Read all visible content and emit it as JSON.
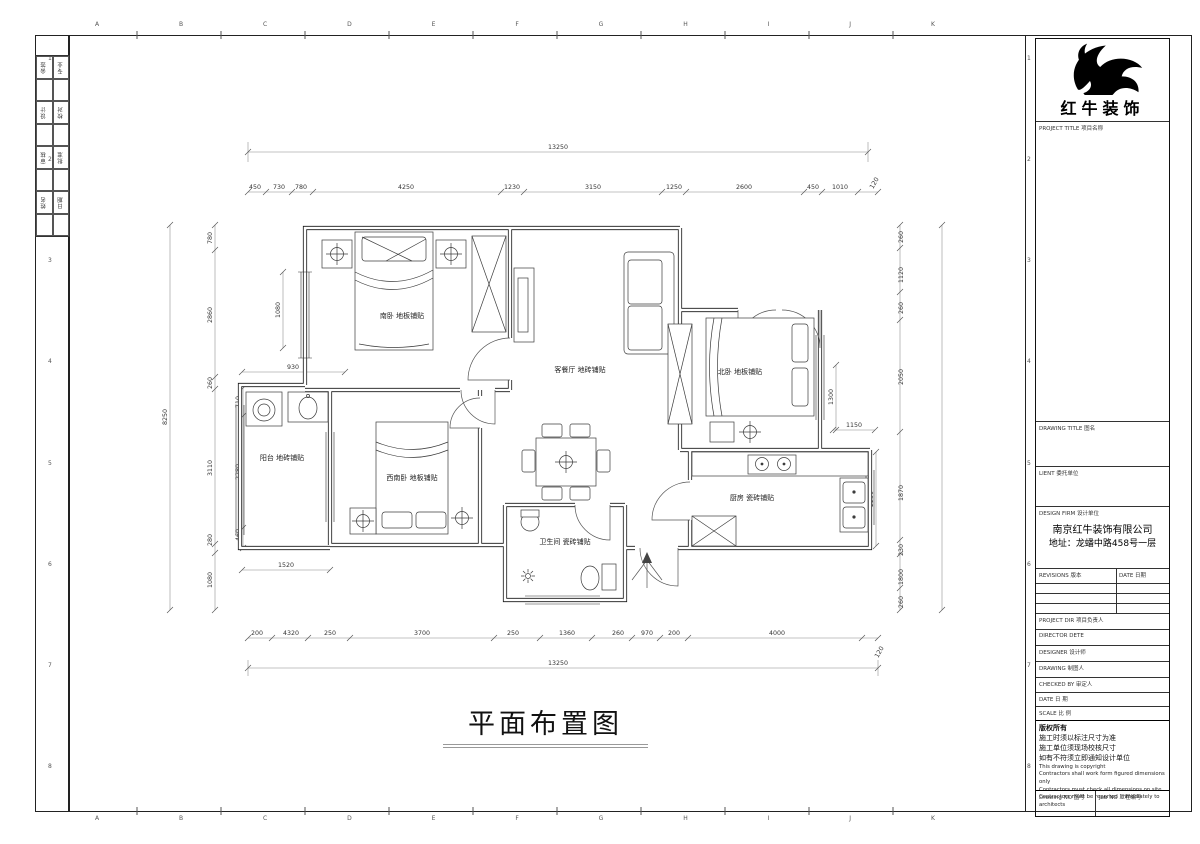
{
  "sheet": {
    "top_letters": [
      "A",
      "B",
      "C",
      "D",
      "E",
      "F",
      "G",
      "H",
      "I",
      "J",
      "K"
    ],
    "bottom_letters": [
      "A",
      "B",
      "C",
      "D",
      "E",
      "F",
      "G",
      "H",
      "I",
      "J",
      "K"
    ],
    "left_numbers": [
      "1",
      "2",
      "3",
      "4",
      "5",
      "6",
      "7",
      "8"
    ],
    "right_numbers": [
      "1",
      "2",
      "3",
      "4",
      "5",
      "6",
      "7",
      "8"
    ]
  },
  "signoff": {
    "rows": [
      [
        "会签",
        "专业"
      ],
      [
        "设计",
        "校对"
      ],
      [
        "审核",
        "批准"
      ],
      [
        "姓名",
        "日期"
      ]
    ]
  },
  "titleblock": {
    "company": "红牛装饰",
    "project_title_label": "PROJECT TITLE  项目名称",
    "drawing_title_label": "DRAWING TITLE  图名",
    "client_label": "LIENT  委托单位",
    "design_firm_label": "DESIGN FIRM  设计单位",
    "firm_name": "南京红牛装饰有限公司",
    "firm_address": "地址：龙蟠中路458号一层",
    "revisions_label": "REVISIONS  版本",
    "revisions_date_label": "DATE 日期",
    "project_dir_label": "PROJECT DIR   项目负责人",
    "director_label": "DIRECTOR DETE",
    "designer_label": "DESIGNER      设计师",
    "drawing_label": "DRAWING       制图人",
    "checked_label": "CHECKED BY   审定人",
    "date_label": "DATE          日  期",
    "scale_label": "SCALE         比  例",
    "copyright_title": "版权所有",
    "notes_cn": [
      "施工时须以标注尺寸为准",
      "施工单位须现场校核尺寸",
      "如有不符须立即通知设计单位"
    ],
    "notes_en": [
      "This drawing is copyright",
      "Contractors shall work form figured dimensions only",
      "Contractors must check all dimensions on site",
      "Contractors must be reported immediately to architects"
    ],
    "drawing_no_label": "Drawing NO  图号",
    "job_no_label": "Job NO  工程编号"
  },
  "plan": {
    "title": "平面布置图",
    "rooms": {
      "south_bedroom": "南卧 地板铺贴",
      "living_dining": "客餐厅 地砖铺贴",
      "north_bedroom": "北卧 地板铺贴",
      "southwest_bedroom": "西南卧 地板铺贴",
      "balcony": "阳台 地砖铺贴",
      "bathroom": "卫生间 瓷砖铺贴",
      "kitchen": "厨房 瓷砖铺贴"
    },
    "dims": {
      "top_overall": "13250",
      "bottom_overall": "13250",
      "left_overall": "8250",
      "right_overall": "8250",
      "top_segments": [
        "450",
        "730",
        "780",
        "4250",
        "1230",
        "3150",
        "1250",
        "2600",
        "450",
        "1010",
        "120"
      ],
      "bottom_segments": [
        "200",
        "4320",
        "250",
        "3700",
        "250",
        "1360",
        "260",
        "970",
        "200",
        "4000",
        "120"
      ],
      "left_segments": [
        "780",
        "2860",
        "260",
        "3110",
        "280",
        "1080"
      ],
      "right_segments": [
        "260",
        "1120",
        "260",
        "2050",
        "1870",
        "230",
        "1800",
        "260"
      ],
      "inner": [
        "930",
        "1520",
        "1150",
        "1300",
        "2230",
        "1080",
        "710",
        "2280",
        "460"
      ]
    }
  }
}
